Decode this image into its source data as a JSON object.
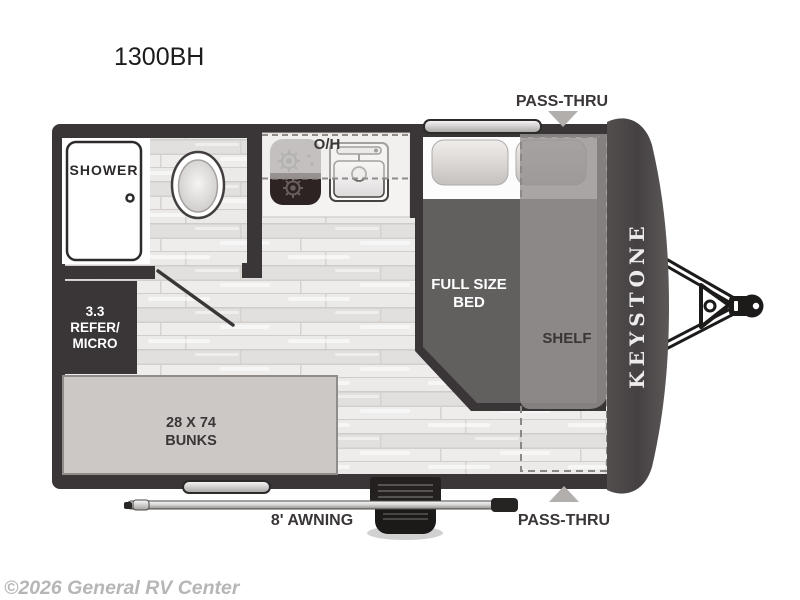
{
  "page": {
    "title": "1300BH",
    "watermark": "©2026 General RV Center"
  },
  "brand": {
    "name": "KEYSTONE"
  },
  "floorplan": {
    "passthru_top": "PASS-THRU",
    "passthru_bottom": "PASS-THRU",
    "awning": "8' AWNING",
    "shower": "SHOWER",
    "overhead": "O/H",
    "bed": {
      "line1": "FULL SIZE",
      "line2": "BED"
    },
    "shelf": "SHELF",
    "refrigerator": {
      "line1": "3.3",
      "line2": "REFER/",
      "line3": "MICRO"
    },
    "bunks": {
      "line1": "28 X 74",
      "line2": "BUNKS"
    }
  },
  "colors": {
    "wall": "#3a3637",
    "front_cap": "#4a4646",
    "floor_light": "#eceae8",
    "bed_mattress": "#625f5f",
    "shelf_overlay": "#969190",
    "bunk_fill": "#cbc8c6",
    "counter_fill": "#f4f3f1",
    "arrow_gray": "#b1aeac",
    "brand_text": "#edebeb",
    "label_dark": "#3a3637",
    "watermark_gray": "#b6b6b6"
  }
}
